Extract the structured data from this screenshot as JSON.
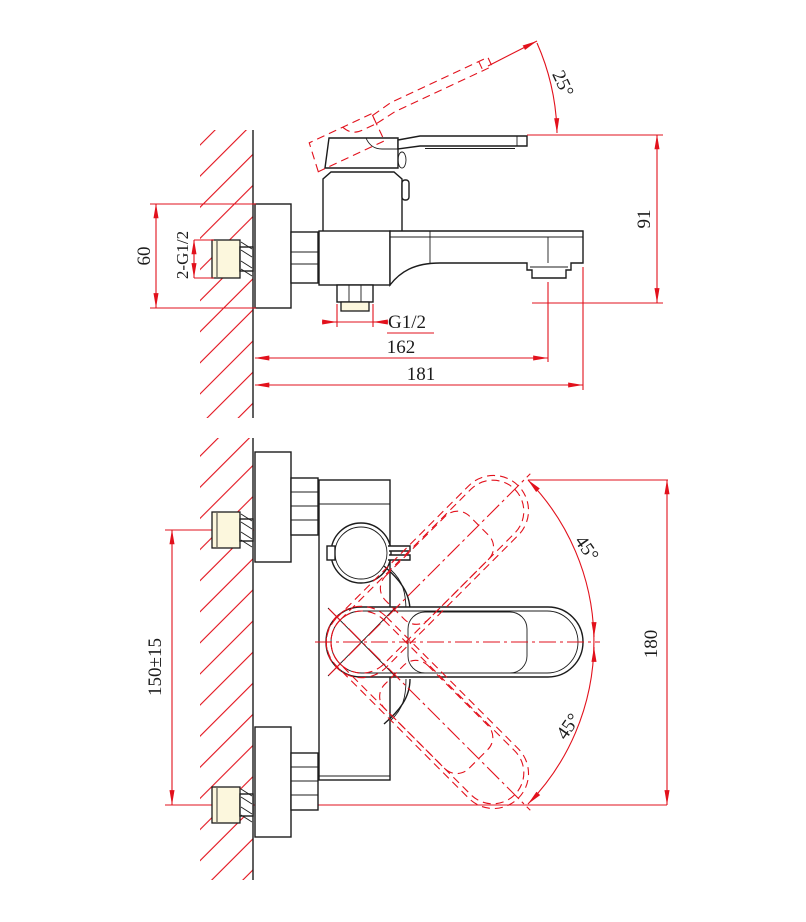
{
  "drawing": {
    "type": "technical-dimension-drawing",
    "subject": "wall-mounted single-lever bath shower mixer faucet, side installation view and front view",
    "views": {
      "side_view": {
        "labels": {
          "handle_angle": "25°",
          "height": "91",
          "escutcheon_height": "60",
          "wall_inlet_thread": "2-G1/2",
          "shower_outlet_thread": "G1/2",
          "spout_center_reach": "162",
          "overall_reach": "181"
        }
      },
      "front_view": {
        "labels": {
          "inlet_spacing": "150±15",
          "overall_height": "180",
          "handle_swing_up": "45°",
          "handle_swing_down": "45°"
        }
      }
    },
    "colors": {
      "dimension_red": "#e2111c",
      "outline_black": "#1c1c1c",
      "fitting_fill": "#fcf7dd",
      "background": "#ffffff"
    }
  }
}
